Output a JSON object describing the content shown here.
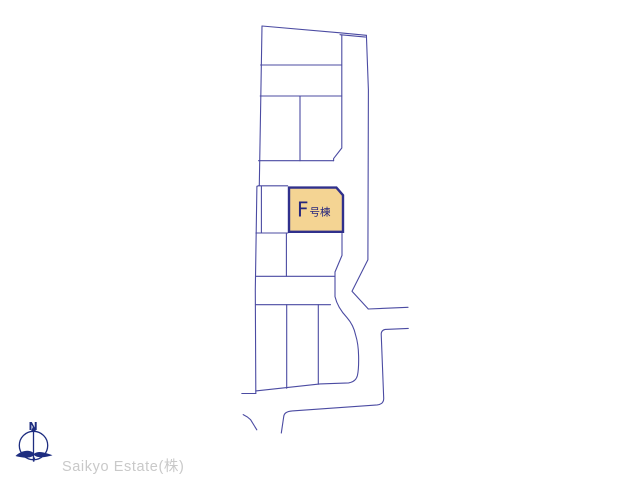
{
  "page": {
    "background": "#ffffff"
  },
  "map": {
    "line_color": "#4b4ba2",
    "parcel": {
      "letter": "F",
      "suffix": "号棟",
      "label": "F号棟",
      "fill": "#f4d493",
      "border": "#30308c",
      "text_color": "#26267d"
    }
  },
  "compass": {
    "north_label": "N",
    "color": "#1e2d80"
  },
  "footer": {
    "company": "Saikyo Estate(株)",
    "text_color": "#c9c9c9"
  }
}
